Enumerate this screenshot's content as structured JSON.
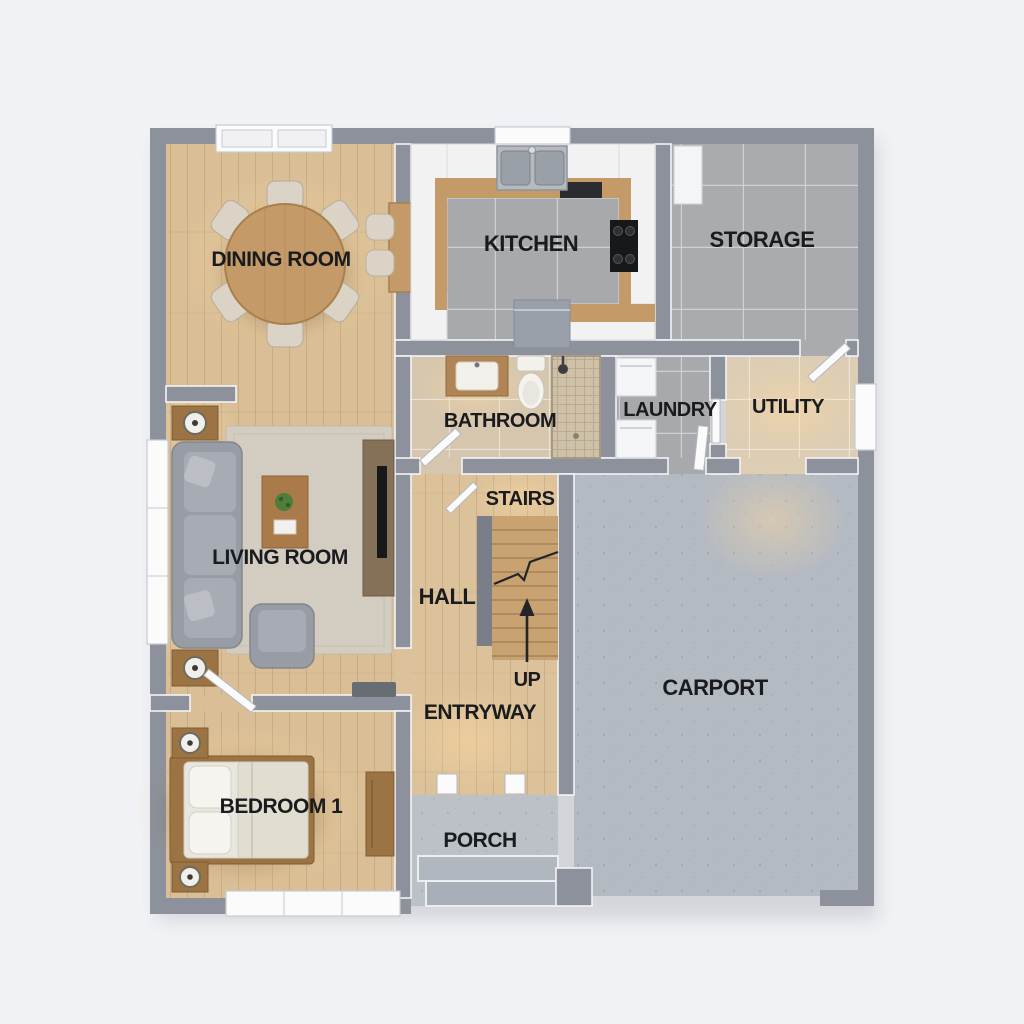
{
  "title": "House Floor Plan",
  "colors": {
    "background": "#f1f2f5",
    "wall": "#8d919b",
    "wood_floor": "#d9be96",
    "stair_wood": "#c8a271",
    "tile_gray": "#a7a9ac",
    "tile_beige": "#d8cab2",
    "concrete_carport": "#b4bac2",
    "concrete_porch": "#bcc1c8",
    "rug": "#d3ccc0",
    "sofa_gray": "#989ca4",
    "furniture_wood": "#a97c4d",
    "counter_white": "#f2f2f3",
    "countertop_wood": "#c49a68",
    "label_text": "#1a1b1e"
  },
  "rooms": [
    {
      "name": "dining-room",
      "label": "DINING ROOM"
    },
    {
      "name": "kitchen",
      "label": "KITCHEN"
    },
    {
      "name": "storage",
      "label": "STORAGE"
    },
    {
      "name": "bathroom",
      "label": "BATHROOM"
    },
    {
      "name": "laundry",
      "label": "LAUNDRY"
    },
    {
      "name": "utility",
      "label": "UTILITY"
    },
    {
      "name": "stairs",
      "label": "STAIRS"
    },
    {
      "name": "living-room",
      "label": "LIVING ROOM"
    },
    {
      "name": "hall",
      "label": "HALL"
    },
    {
      "name": "entryway",
      "label": "ENTRYWAY"
    },
    {
      "name": "carport",
      "label": "CARPORT"
    },
    {
      "name": "bedroom-1",
      "label": "BEDROOM 1"
    },
    {
      "name": "porch",
      "label": "PORCH"
    }
  ],
  "annotations": {
    "up_label": "UP"
  }
}
